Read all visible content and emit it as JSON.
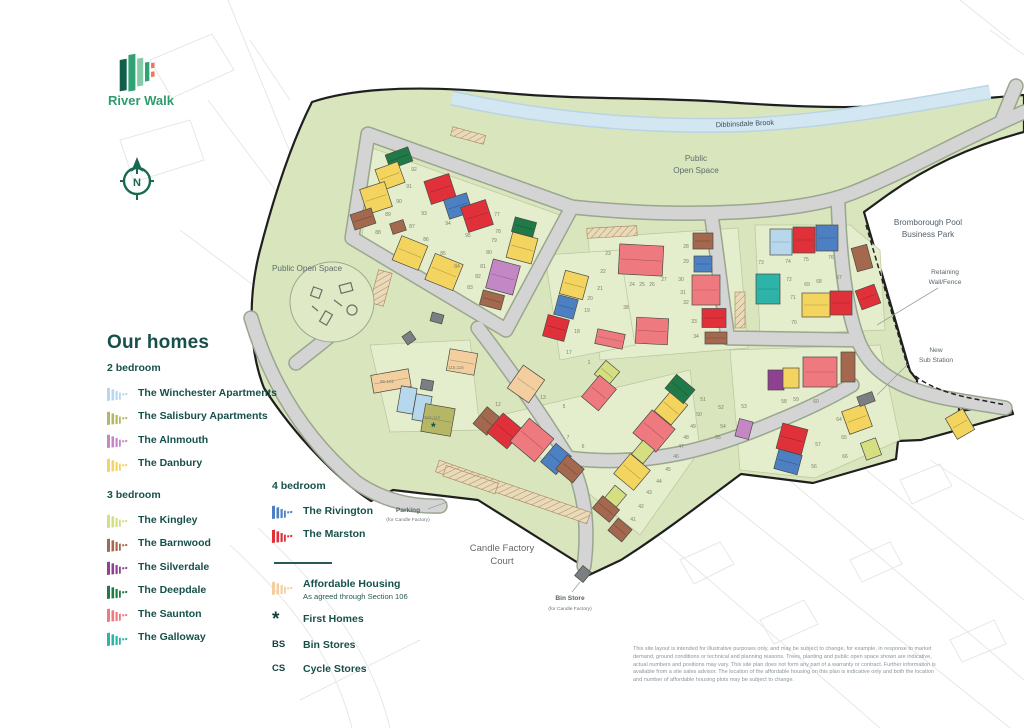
{
  "brand": {
    "name": "River Walk"
  },
  "compass": {
    "label": "N"
  },
  "legend": {
    "title": "Our homes",
    "groups": [
      {
        "title": "2 bedroom",
        "items": [
          {
            "name": "The Winchester Apartments",
            "color": "#b7d8ec"
          },
          {
            "name": "The Salisbury Apartments",
            "color": "#b5b766"
          },
          {
            "name": "The Alnmouth",
            "color": "#c487c6"
          },
          {
            "name": "The Danbury",
            "color": "#f3d45e"
          }
        ]
      },
      {
        "title": "3 bedroom",
        "items": [
          {
            "name": "The Kingley",
            "color": "#d6de82"
          },
          {
            "name": "The Barnwood",
            "color": "#a3684e"
          },
          {
            "name": "The Silverdale",
            "color": "#8d4190"
          },
          {
            "name": "The Deepdale",
            "color": "#1f7a47"
          },
          {
            "name": "The Saunton",
            "color": "#ee7a80"
          },
          {
            "name": "The Galloway",
            "color": "#2eb3a8"
          }
        ]
      },
      {
        "title": "4 bedroom",
        "items": [
          {
            "name": "The Rivington",
            "color": "#4d80c2"
          },
          {
            "name": "The Marston",
            "color": "#e0313b"
          }
        ]
      }
    ],
    "extras": {
      "affordable": {
        "label": "Affordable Housing",
        "sublabel": "As agreed through Section 106",
        "color": "#f3cf9f"
      },
      "first_homes": {
        "symbol": "*",
        "label": "First Homes"
      },
      "bin_stores": {
        "symbol": "BS",
        "label": "Bin Stores"
      },
      "cycle_stores": {
        "symbol": "CS",
        "label": "Cycle Stores"
      }
    }
  },
  "map": {
    "labels": {
      "brook": "Dibbinsdale Brook",
      "pos_top": {
        "line1": "Public",
        "line2": "Open Space"
      },
      "pos_left": "Public Open Space",
      "business_park": {
        "line1": "Bromborough Pool",
        "line2": "Business Park"
      },
      "retaining": {
        "line1": "Retaining",
        "line2": "Wall/Fence"
      },
      "substation": {
        "line1": "New",
        "line2": "Sub Station"
      },
      "parking": {
        "line1": "Parking",
        "line2": "(for Candle Factory)"
      },
      "court": {
        "line1": "Candle Factory",
        "line2": "Court"
      },
      "binstore": {
        "line1": "Bin Store",
        "line2": "(for Candle Factory)"
      }
    },
    "house_colors": {
      "wa": "#b7d8ec",
      "sa": "#b5b766",
      "al": "#c487c6",
      "da": "#f3d45e",
      "ki": "#d6de82",
      "bw": "#a3684e",
      "sv": "#8d4190",
      "dd": "#1f7a47",
      "sn": "#ee7a80",
      "gw": "#2eb3a8",
      "rv": "#4d80c2",
      "ma": "#e0313b",
      "af": "#f3cf9f",
      "st": "#7a7f84"
    },
    "houses": [
      [
        399,
        158,
        24,
        15,
        -20,
        "dd"
      ],
      [
        390,
        176,
        24,
        22,
        -20,
        "da"
      ],
      [
        376,
        198,
        26,
        26,
        -18,
        "da"
      ],
      [
        363,
        219,
        22,
        16,
        -18,
        "bw"
      ],
      [
        440,
        189,
        26,
        24,
        -18,
        "ma"
      ],
      [
        458,
        206,
        24,
        20,
        -18,
        "rv"
      ],
      [
        477,
        216,
        26,
        26,
        -18,
        "ma"
      ],
      [
        398,
        227,
        14,
        11,
        -18,
        "bw"
      ],
      [
        524,
        227,
        22,
        15,
        15,
        "dd"
      ],
      [
        522,
        248,
        26,
        26,
        15,
        "da"
      ],
      [
        410,
        253,
        28,
        26,
        22,
        "da"
      ],
      [
        444,
        272,
        30,
        28,
        22,
        "da"
      ],
      [
        503,
        277,
        28,
        30,
        15,
        "al"
      ],
      [
        492,
        300,
        22,
        15,
        15,
        "bw"
      ],
      [
        391,
        381,
        38,
        18,
        -10,
        "af"
      ],
      [
        407,
        400,
        16,
        26,
        10,
        "wa"
      ],
      [
        422,
        408,
        16,
        26,
        10,
        "wa"
      ],
      [
        438,
        420,
        30,
        28,
        10,
        "sa"
      ],
      [
        462,
        362,
        28,
        22,
        10,
        "af"
      ],
      [
        526,
        384,
        26,
        28,
        35,
        "af"
      ],
      [
        641,
        260,
        44,
        30,
        3,
        "sn"
      ],
      [
        703,
        241,
        20,
        16,
        0,
        "bw"
      ],
      [
        703,
        264,
        18,
        16,
        0,
        "rv"
      ],
      [
        706,
        290,
        28,
        30,
        0,
        "sn"
      ],
      [
        714,
        318,
        24,
        19,
        0,
        "ma"
      ],
      [
        716,
        338,
        22,
        12,
        0,
        "bw"
      ],
      [
        768,
        289,
        24,
        30,
        0,
        "gw"
      ],
      [
        652,
        331,
        32,
        26,
        3,
        "sn"
      ],
      [
        610,
        339,
        28,
        15,
        12,
        "sn"
      ],
      [
        574,
        285,
        24,
        24,
        15,
        "da"
      ],
      [
        566,
        307,
        20,
        20,
        15,
        "rv"
      ],
      [
        556,
        328,
        22,
        22,
        15,
        "ma"
      ],
      [
        487,
        421,
        18,
        22,
        40,
        "bw"
      ],
      [
        505,
        431,
        26,
        25,
        40,
        "ma"
      ],
      [
        532,
        440,
        32,
        30,
        40,
        "sn"
      ],
      [
        556,
        459,
        20,
        24,
        40,
        "rv"
      ],
      [
        570,
        469,
        22,
        18,
        40,
        "bw"
      ],
      [
        654,
        431,
        30,
        30,
        40,
        "sn"
      ],
      [
        671,
        408,
        22,
        26,
        40,
        "da"
      ],
      [
        680,
        389,
        24,
        18,
        40,
        "dd"
      ],
      [
        607,
        373,
        18,
        18,
        40,
        "ki"
      ],
      [
        599,
        393,
        22,
        28,
        40,
        "sn"
      ],
      [
        643,
        452,
        15,
        18,
        40,
        "ki"
      ],
      [
        632,
        472,
        26,
        26,
        40,
        "da"
      ],
      [
        615,
        497,
        15,
        18,
        40,
        "ki"
      ],
      [
        606,
        509,
        22,
        16,
        40,
        "bw"
      ],
      [
        620,
        530,
        18,
        16,
        40,
        "bw"
      ],
      [
        781,
        242,
        22,
        26,
        0,
        "wa"
      ],
      [
        804,
        240,
        22,
        26,
        0,
        "ma"
      ],
      [
        827,
        238,
        22,
        26,
        0,
        "rv"
      ],
      [
        816,
        305,
        28,
        24,
        0,
        "da"
      ],
      [
        841,
        303,
        22,
        24,
        0,
        "ma"
      ],
      [
        862,
        258,
        16,
        24,
        -15,
        "bw"
      ],
      [
        868,
        297,
        20,
        20,
        -20,
        "ma"
      ],
      [
        776,
        380,
        16,
        20,
        0,
        "sv"
      ],
      [
        791,
        378,
        16,
        20,
        0,
        "da"
      ],
      [
        820,
        372,
        34,
        30,
        0,
        "sn"
      ],
      [
        848,
        367,
        14,
        30,
        0,
        "bw"
      ],
      [
        744,
        429,
        14,
        18,
        15,
        "al"
      ],
      [
        792,
        439,
        26,
        26,
        15,
        "ma"
      ],
      [
        788,
        462,
        24,
        20,
        15,
        "rv"
      ],
      [
        857,
        419,
        24,
        24,
        -20,
        "da"
      ],
      [
        871,
        449,
        16,
        18,
        -20,
        "ki"
      ],
      [
        960,
        424,
        20,
        24,
        -30,
        "da"
      ],
      [
        427,
        385,
        12,
        10,
        10,
        "st"
      ],
      [
        409,
        338,
        10,
        10,
        -35,
        "st"
      ],
      [
        583,
        574,
        11,
        13,
        40,
        "st"
      ],
      [
        866,
        399,
        16,
        10,
        -20,
        "st"
      ],
      [
        437,
        318,
        12,
        9,
        15,
        "st"
      ]
    ],
    "plot_numbers": [
      [
        "92",
        414,
        171
      ],
      [
        "91",
        409,
        188
      ],
      [
        "90",
        399,
        203
      ],
      [
        "89",
        388,
        216
      ],
      [
        "88",
        378,
        234
      ],
      [
        "87",
        412,
        228
      ],
      [
        "86",
        426,
        241
      ],
      [
        "85",
        443,
        255
      ],
      [
        "84",
        457,
        268
      ],
      [
        "83",
        470,
        289
      ],
      [
        "82",
        478,
        278
      ],
      [
        "81",
        483,
        268
      ],
      [
        "80",
        489,
        254
      ],
      [
        "79",
        494,
        242
      ],
      [
        "78",
        498,
        233
      ],
      [
        "77",
        497,
        216
      ],
      [
        "95",
        468,
        237
      ],
      [
        "94",
        448,
        225
      ],
      [
        "93",
        424,
        215
      ],
      [
        "24",
        632,
        286
      ],
      [
        "25",
        642,
        286
      ],
      [
        "26",
        652,
        286
      ],
      [
        "27",
        664,
        281
      ],
      [
        "28",
        686,
        248
      ],
      [
        "29",
        686,
        263
      ],
      [
        "30",
        681,
        281
      ],
      [
        "31",
        683,
        294
      ],
      [
        "32",
        686,
        304
      ],
      [
        "33",
        694,
        323
      ],
      [
        "34",
        696,
        338
      ],
      [
        "38",
        626,
        309
      ],
      [
        "18",
        577,
        333
      ],
      [
        "19",
        587,
        312
      ],
      [
        "20",
        590,
        300
      ],
      [
        "21",
        600,
        290
      ],
      [
        "22",
        603,
        273
      ],
      [
        "23",
        608,
        255
      ],
      [
        "17",
        569,
        354
      ],
      [
        "1",
        589,
        364
      ],
      [
        "5",
        564,
        408
      ],
      [
        "6",
        583,
        448
      ],
      [
        "7",
        568,
        439
      ],
      [
        "12",
        498,
        406
      ],
      [
        "13",
        543,
        399
      ],
      [
        "73",
        761,
        264
      ],
      [
        "74",
        788,
        263
      ],
      [
        "75",
        806,
        261
      ],
      [
        "76",
        831,
        259
      ],
      [
        "72",
        789,
        281
      ],
      [
        "71",
        793,
        299
      ],
      [
        "70",
        794,
        324
      ],
      [
        "69",
        807,
        286
      ],
      [
        "68",
        819,
        283
      ],
      [
        "67",
        839,
        279
      ],
      [
        "41",
        633,
        521
      ],
      [
        "42",
        641,
        508
      ],
      [
        "43",
        649,
        494
      ],
      [
        "44",
        659,
        483
      ],
      [
        "45",
        668,
        471
      ],
      [
        "46",
        676,
        458
      ],
      [
        "47",
        681,
        448
      ],
      [
        "48",
        686,
        439
      ],
      [
        "49",
        693,
        428
      ],
      [
        "50",
        699,
        416
      ],
      [
        "51",
        703,
        401
      ],
      [
        "52",
        721,
        409
      ],
      [
        "53",
        744,
        408
      ],
      [
        "54",
        723,
        428
      ],
      [
        "55",
        718,
        439
      ],
      [
        "56",
        814,
        468
      ],
      [
        "57",
        818,
        446
      ],
      [
        "58",
        784,
        403
      ],
      [
        "59",
        796,
        401
      ],
      [
        "60",
        816,
        403
      ],
      [
        "64",
        839,
        421
      ],
      [
        "65",
        844,
        439
      ],
      [
        "66",
        845,
        458
      ]
    ],
    "area_labels": [
      [
        "96-101",
        387,
        383
      ],
      [
        "102-110",
        432,
        419
      ],
      [
        "115,116",
        456,
        369
      ]
    ]
  },
  "disclaimer": "This site layout is intended for illustrative purposes only, and may be subject to change, for example, in response to market demand, ground conditions or technical and planning reasons. Trees, planting and public open space shown are indicative, actual numbers and positions may vary. This site plan does not form any part of a warranty or contract. Further information is available from a site sales advisor. The location of the affordable housing on this plan is indicative only and both the location and number of affordable housing plots may be subject to change."
}
